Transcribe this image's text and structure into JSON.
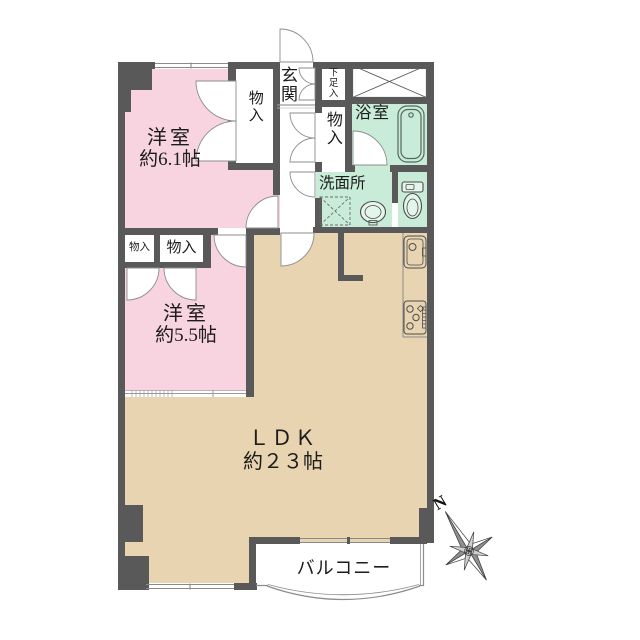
{
  "plan": {
    "rooms": {
      "bedroom1": {
        "name": "洋室",
        "size": "約6.1帖"
      },
      "bedroom2": {
        "name": "洋室",
        "size": "約5.5帖"
      },
      "ldk": {
        "name": "ＬＤＫ",
        "size": "約２３帖"
      },
      "balcony": {
        "name": "バルコニー"
      },
      "entrance": {
        "name": "玄関"
      },
      "shoe_cabinet": {
        "name": "下足入"
      },
      "bathroom": {
        "name": "浴室"
      },
      "washroom": {
        "name": "洗面所"
      },
      "closet_hall_upper": {
        "name": "物入"
      },
      "closet_hall_lower": {
        "name": "物入"
      },
      "closet_bedroom2_small": {
        "name": "物入"
      },
      "closet_bedroom2_large": {
        "name": "物入"
      }
    },
    "compass": {
      "north_label": "N"
    },
    "icons": [
      "bathtub-icon",
      "toilet-icon",
      "washbasin-icon",
      "washing-machine-pan-icon",
      "kitchen-sink-icon",
      "gas-stove-icon",
      "pipe-space-x-icon",
      "compass-rose-icon",
      "door-swing-arcs"
    ],
    "colors": {
      "bedroom_pink": "#f8d4e0",
      "ldk_beige": "#e8d4b0",
      "wet_area_mint": "#c9ecd9",
      "wall_gray": "#595959",
      "background": "#ffffff",
      "line_gray": "#888888"
    }
  }
}
